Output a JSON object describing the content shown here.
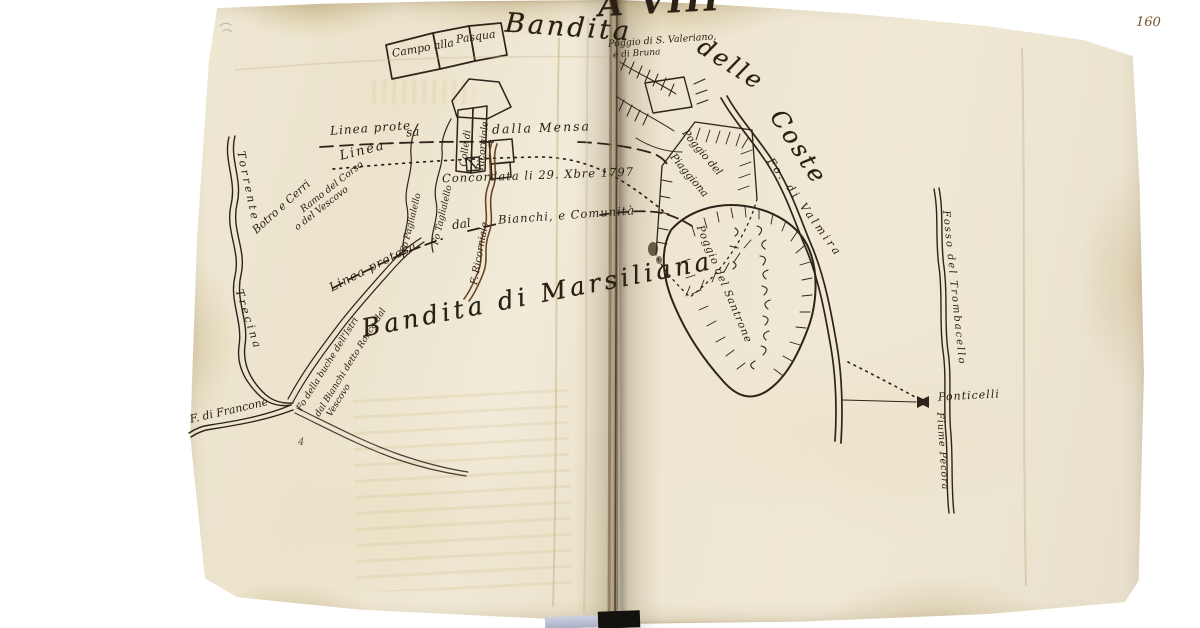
{
  "document": {
    "folio_number": "160",
    "header_fragment": "A VIII"
  },
  "map": {
    "banners": {
      "bandita": "Bandita",
      "delle": "delle",
      "coste": "Coste",
      "marsiliana": "Bandita di Marsiliana"
    },
    "fields": {
      "campo_line1": "Campo alla",
      "campo_line2": "Pasqua",
      "colle_line1": "Colle di",
      "colle_line2": "Ricorniale"
    },
    "boundaries": {
      "protesa_top_a": "Linea prote",
      "protesa_top_b": "sa",
      "dalla_mensa": "dalla Mensa",
      "linea": "Linea",
      "concordata": "Concordata li 29. Xbre 1797",
      "dal": "dal",
      "bianchi_comunita": "Bianchi, e Comunità",
      "protesa_bottom": "Linea protesa"
    },
    "waterways": {
      "torrente": "Torrente",
      "trecina": "Trecina",
      "francone": "F. di Francone",
      "paglialello": "Fo Paglialello",
      "taglialello": "Fo Taglialello",
      "ricorniale": "F. Ricorniale",
      "valmira": "Fo. di Valmira",
      "trombacello": "Fosso del Trombacello",
      "pecora": "Fiume Pecora"
    },
    "places": {
      "valeriano_line1": "Poggio di S. Valeriano,",
      "valeriano_line2": "e di Bruna",
      "piaggione_line1": "Poggio del",
      "piaggione_line2": "Piaggiona",
      "santrone": "Poggio del Santrone",
      "ponticelli": "Ponticelli"
    },
    "notes": {
      "botro_cerri": "Botro e Cerri",
      "ramo_line1": "Ramo del Corso",
      "ramo_line2": "o del Vescovo",
      "istri_line1": "Fo della buche dell'Istri",
      "istri_line2": "dal Bianchi detto Ronco dal",
      "istri_line3": "Vescovo",
      "mark4": "4"
    },
    "ink_colors": {
      "ink": "#2a2014",
      "sepia": "#6a4524",
      "folio_number": "#7a5230"
    }
  }
}
